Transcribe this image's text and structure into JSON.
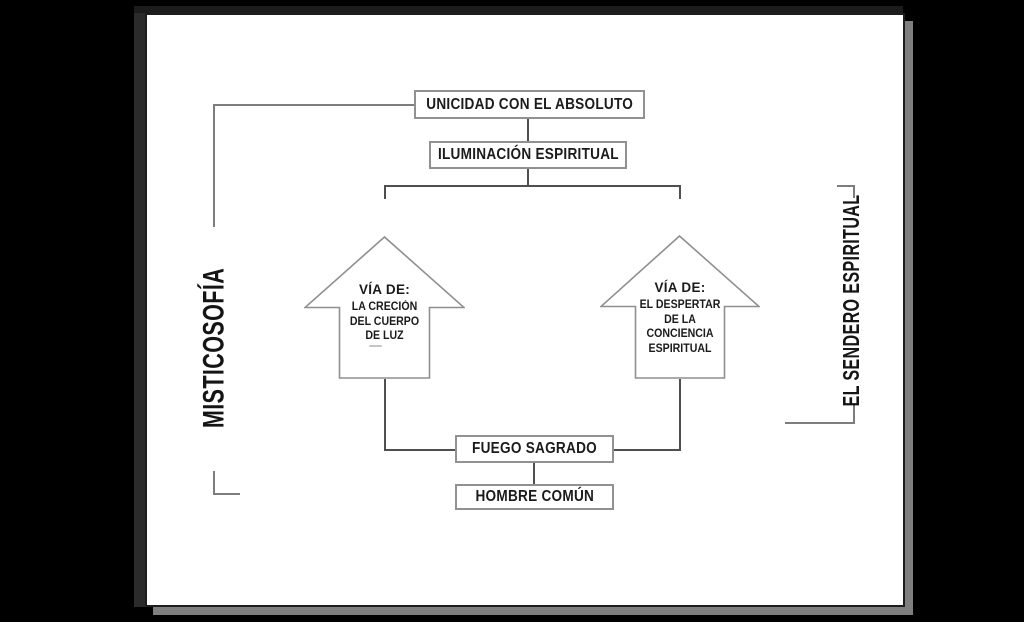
{
  "canvas": {
    "background": "#000000",
    "paper_color": "#ffffff",
    "paper_edge_color": "#2b2b2b",
    "paper_shadow_color": "#7f7f7f"
  },
  "colors": {
    "connector_line": "#4f4f4f",
    "bracket_line": "#7d7d7d",
    "box_border": "#919191",
    "arrow_border": "#8f8f8f",
    "text": "#1b1b1b"
  },
  "diagram": {
    "side_labels": {
      "left": "MISTICOSOFÍA",
      "right": "EL SENDERO ESPIRITUAL"
    },
    "boxes": {
      "absolute": "UNICIDAD CON EL ABSOLUTO",
      "illumination": "ILUMINACIÓN ESPIRITUAL",
      "sacred_fire": "FUEGO SAGRADO",
      "common_man": "HOMBRE COMÚN"
    },
    "arrows": {
      "left": {
        "heading": "VÍA DE:",
        "lines": [
          "LA CRECIÓN",
          "DEL CUERPO",
          "DE LUZ"
        ]
      },
      "right": {
        "heading": "VÍA DE:",
        "lines": [
          "EL DESPERTAR",
          "DE LA",
          "CONCIENCIA",
          "ESPIRITUAL"
        ]
      }
    }
  }
}
